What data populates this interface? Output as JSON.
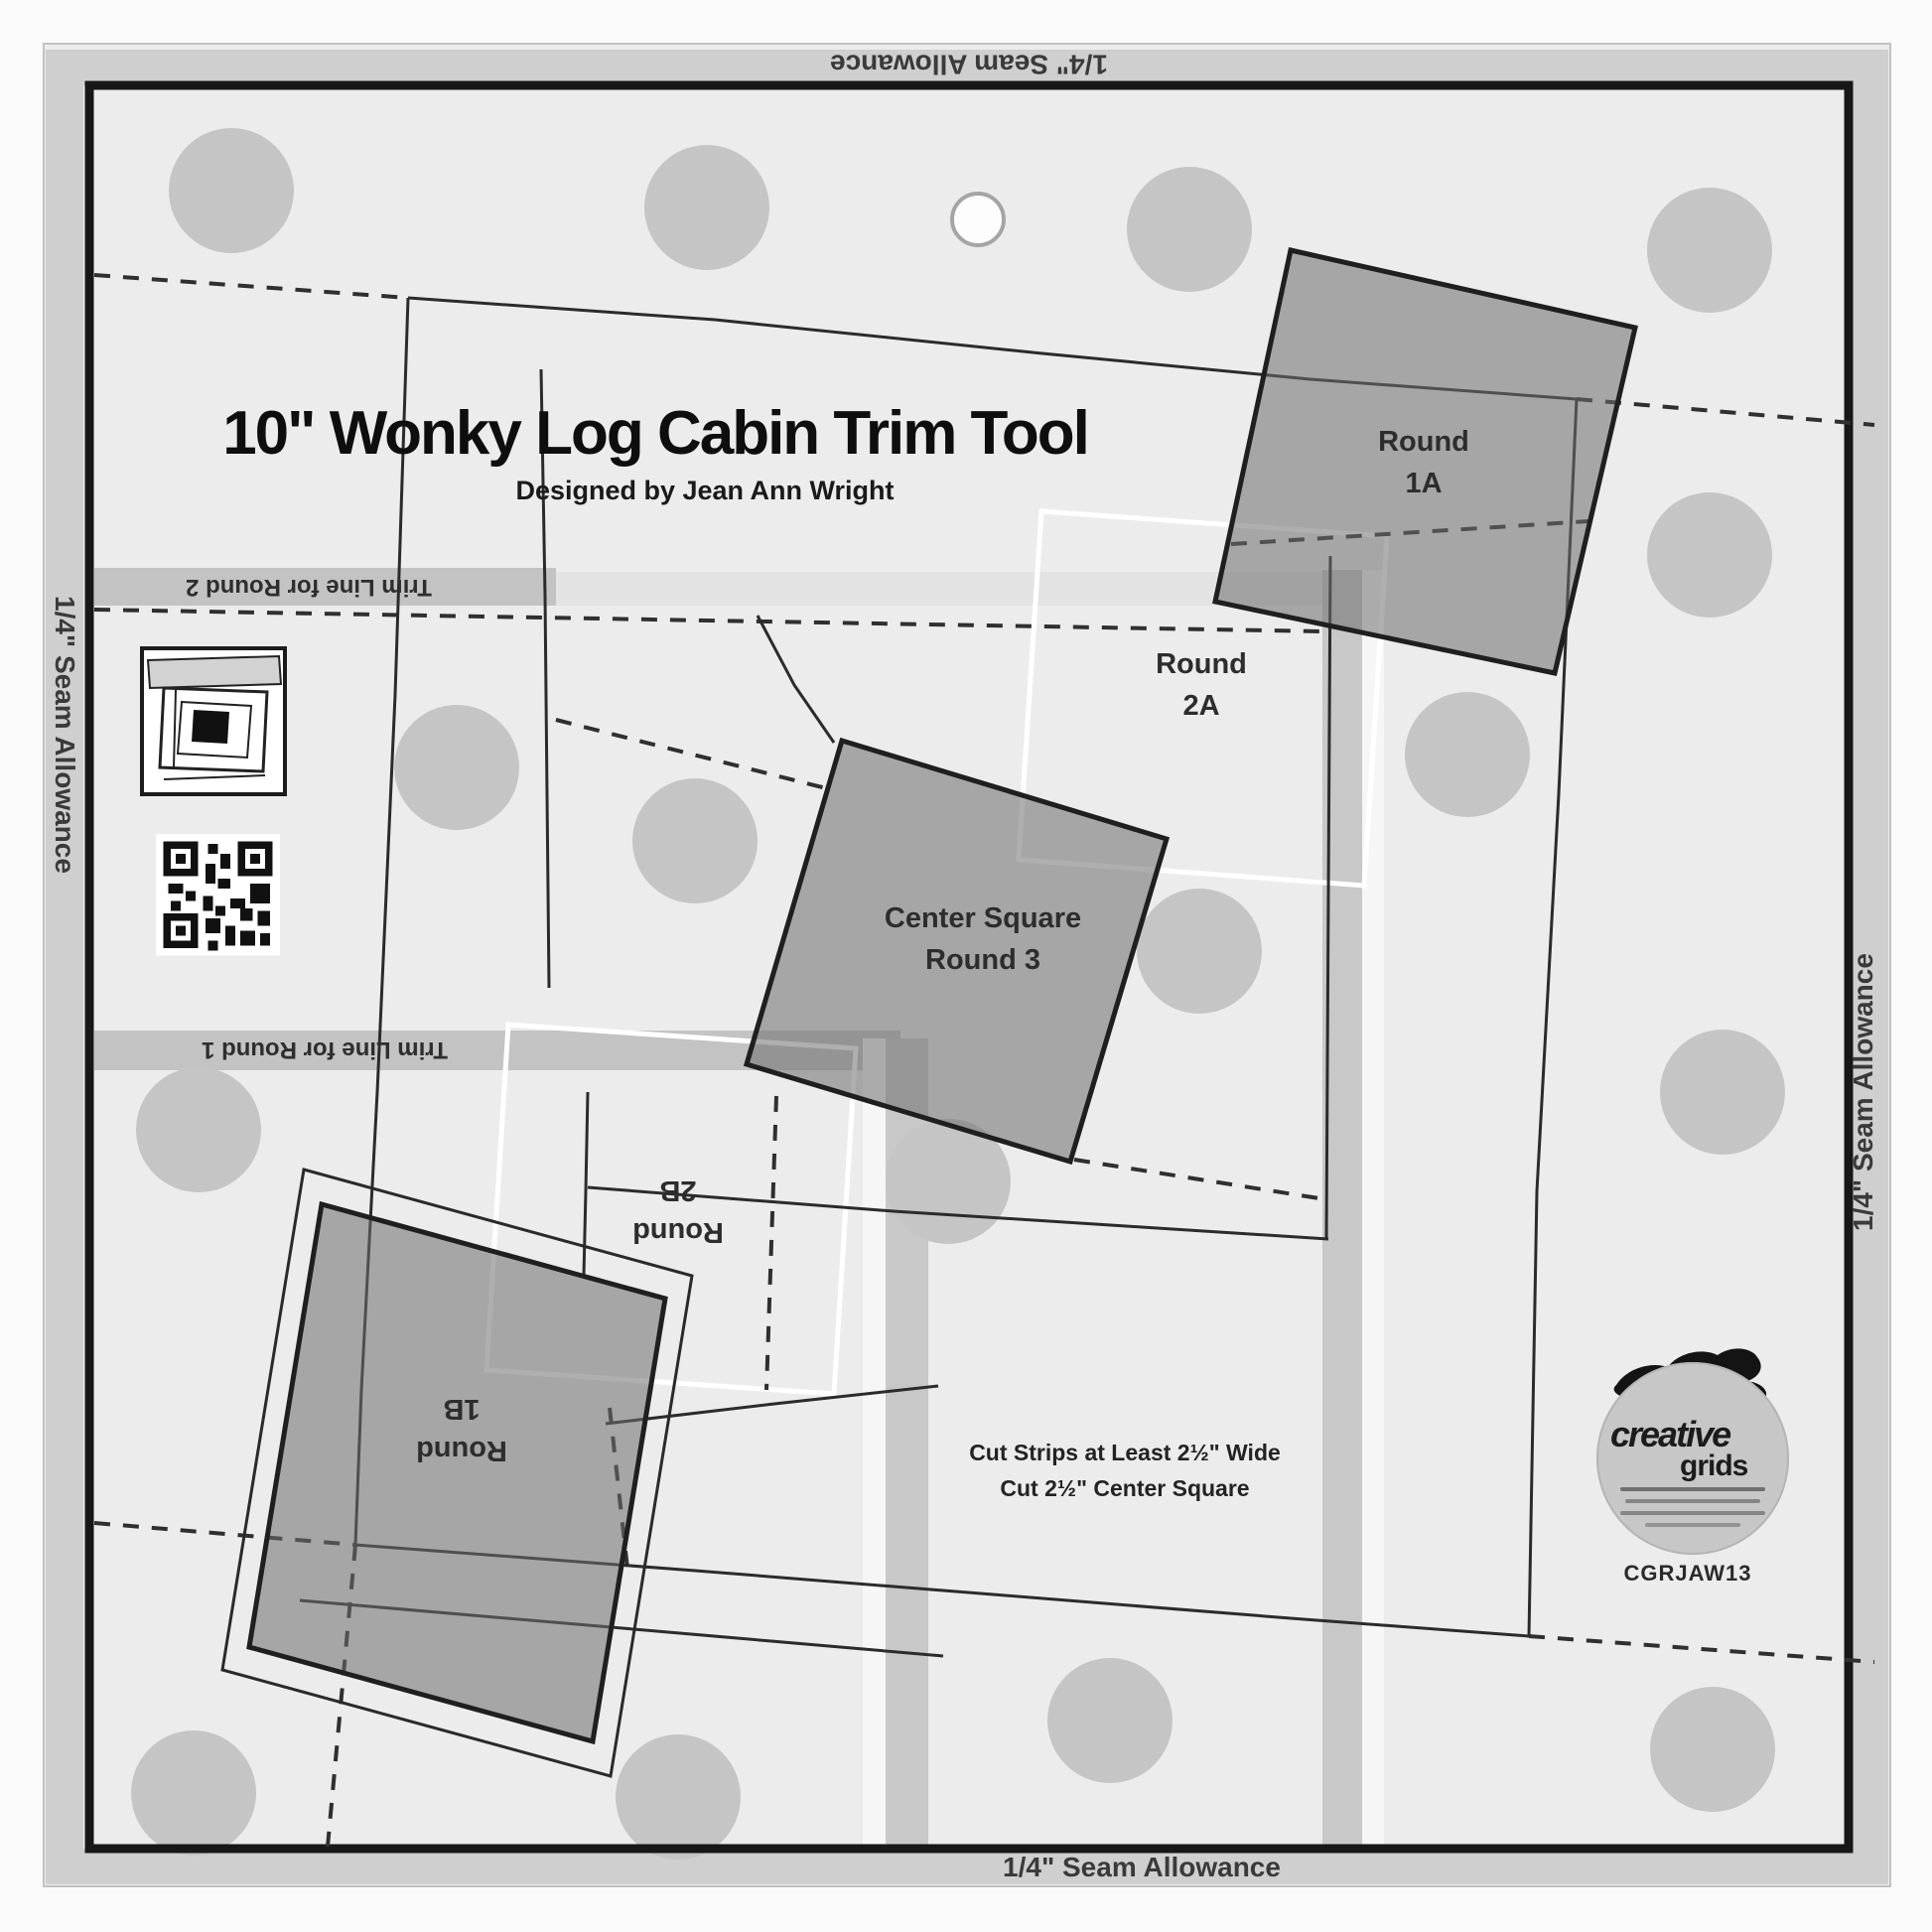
{
  "product": {
    "title": "10\" Wonky Log Cabin Trim Tool",
    "designer": "Designed by Jean Ann Wright"
  },
  "seam_allowance": {
    "top": "1/4\" Seam Allowance",
    "bottom": "1/4\" Seam Allowance",
    "left": "1/4\" Seam Allowance",
    "right": "1/4\" Seam Allowance"
  },
  "trim_lines": {
    "round_2": "Trim Line for Round 2",
    "round_1": "Trim Line for Round 1"
  },
  "patch_labels": {
    "round_1a_line1": "Round",
    "round_1a_line2": "1A",
    "round_2a_line1": "Round",
    "round_2a_line2": "2A",
    "center_line1": "Center Square",
    "center_line2": "Round 3",
    "round_2b_line1": "Round",
    "round_2b_line2": "2B",
    "round_1b_line1": "Round",
    "round_1b_line2": "1B"
  },
  "instructions": {
    "line1": "Cut Strips at Least 2½\" Wide",
    "line2": "Cut 2½\" Center Square"
  },
  "logo": {
    "brand_word_1": "creative",
    "brand_word_2": "grids",
    "product_code": "CGRJAW13"
  },
  "colors": {
    "ruler_body": "#ececec",
    "seam_band": "#cfcfcf",
    "trim_band": "#c3c3c3",
    "grip_dot": "#c5c5c5",
    "patch_fill": "#a6a6a6",
    "frame": "#171717"
  }
}
